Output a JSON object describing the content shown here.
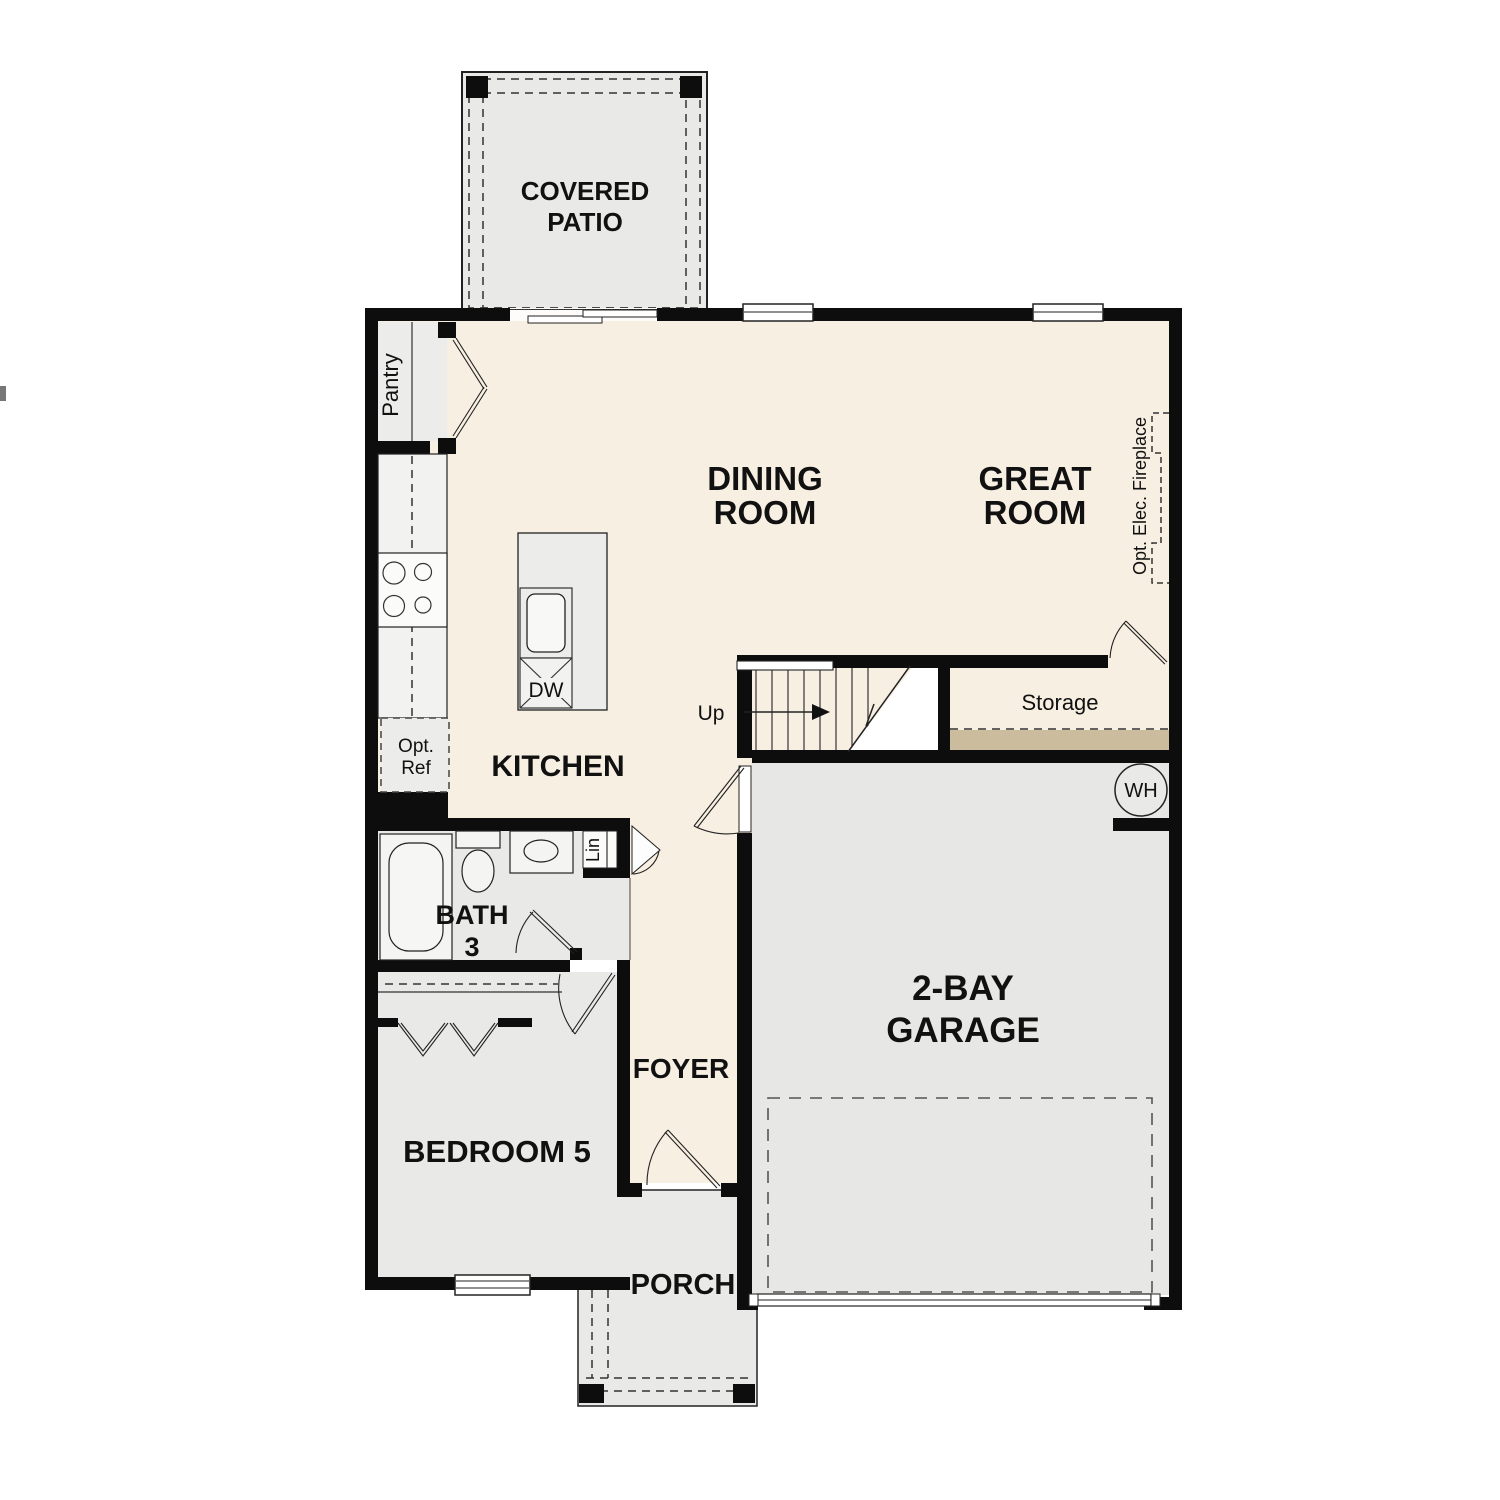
{
  "rooms": {
    "covered_patio": {
      "line1": "COVERED",
      "line2": "PATIO"
    },
    "dining_room": {
      "line1": "DINING",
      "line2": "ROOM"
    },
    "great_room": {
      "line1": "GREAT",
      "line2": "ROOM"
    },
    "kitchen": {
      "label": "KITCHEN"
    },
    "bath3": {
      "line1": "BATH",
      "line2": "3"
    },
    "bedroom5": {
      "label": "BEDROOM 5"
    },
    "foyer": {
      "label": "FOYER"
    },
    "porch": {
      "label": "PORCH"
    },
    "garage": {
      "line1": "2-BAY",
      "line2": "GARAGE"
    },
    "storage": {
      "label": "Storage"
    }
  },
  "annotations": {
    "pantry": "Pantry",
    "opt_ref": {
      "line1": "Opt.",
      "line2": "Ref"
    },
    "dw": "DW",
    "up": "Up",
    "wh": "WH",
    "lin": "Lin",
    "fireplace": "Opt. Elec. Fireplace"
  },
  "colors": {
    "wall": "#0d0d0d",
    "floor_living": "#f8efe3",
    "floor_secondary": "#e9e9e7",
    "floor_garage": "#e7e7e5",
    "storage_strip": "#cbbc9e",
    "background": "#ffffff"
  }
}
